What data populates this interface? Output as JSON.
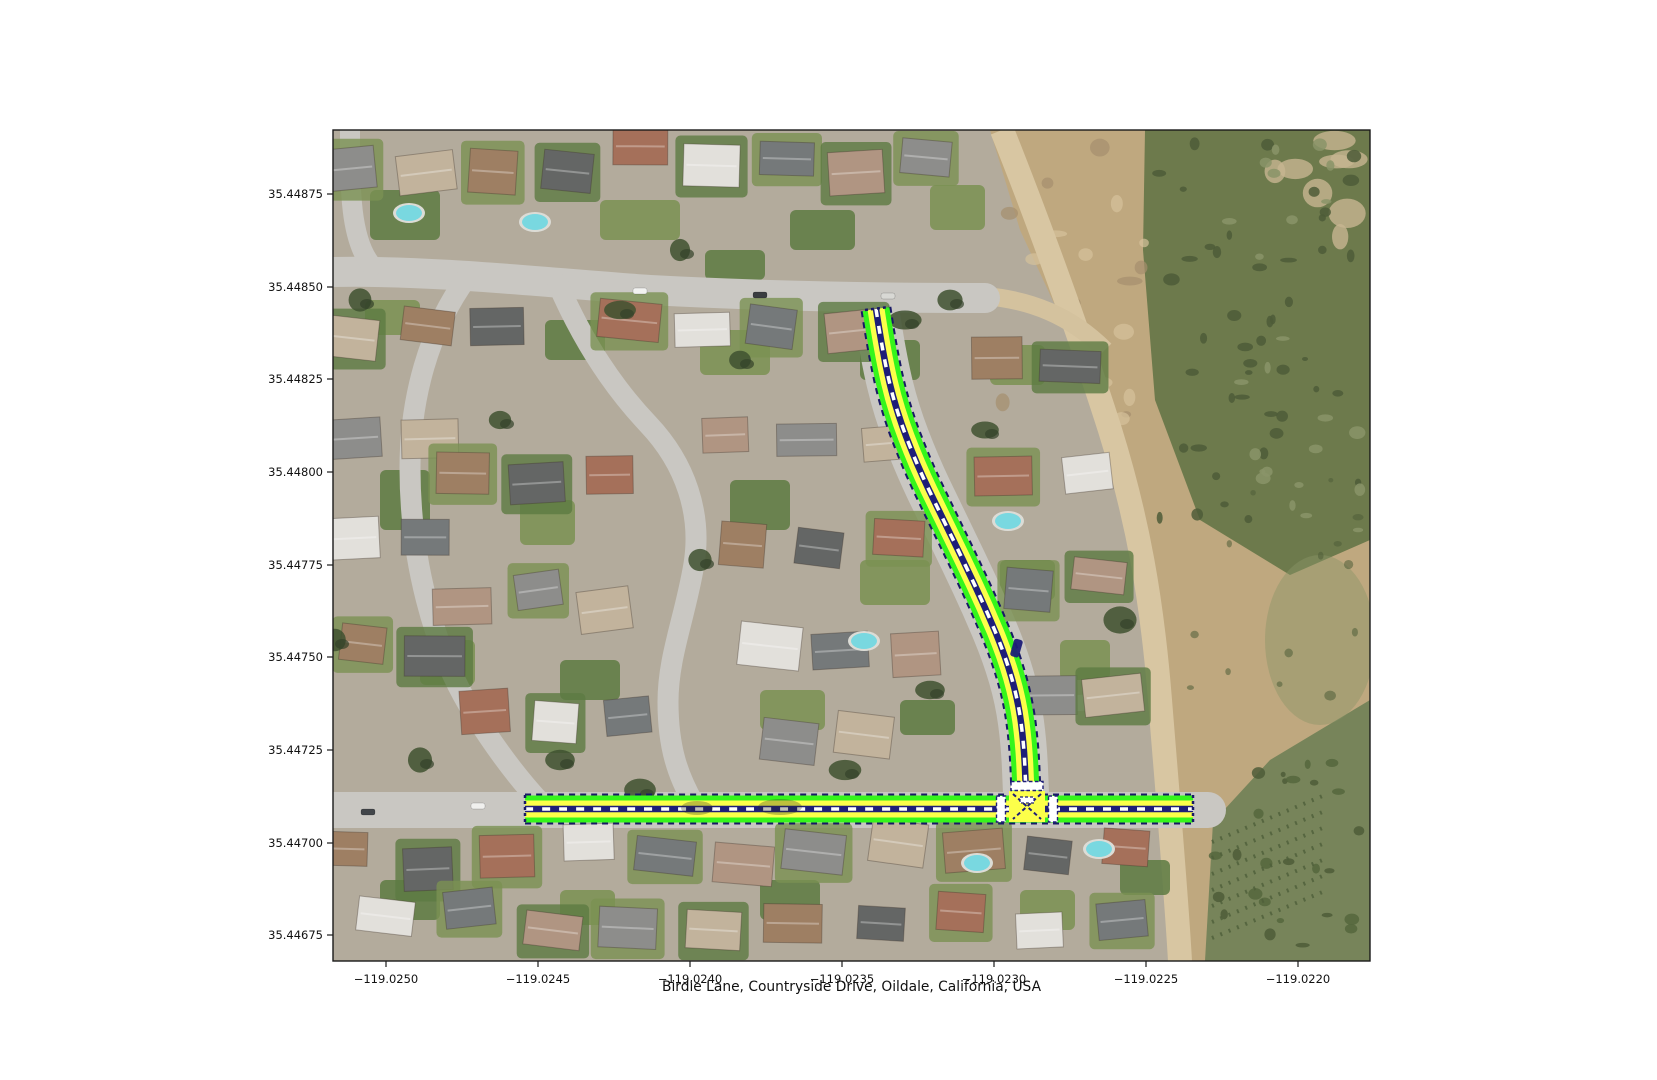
{
  "figure": {
    "title": "Birdie Lane, Countryside Drive, Oildale, California, USA",
    "x_axis": {
      "ticks": [
        "−119.0250",
        "−119.0245",
        "−119.0240",
        "−119.0235",
        "−119.0230",
        "−119.0225",
        "−119.0220"
      ]
    },
    "y_axis": {
      "ticks": [
        "35.44875",
        "35.44850",
        "35.44825",
        "35.44800",
        "35.44775",
        "35.44750",
        "35.44725",
        "35.44700",
        "35.44675"
      ]
    }
  },
  "map": {
    "route_overlay": {
      "colors": {
        "edge_green": "#35f51c",
        "lane_yellow": "#fcff4a",
        "center_navy": "#1e1e78",
        "border_navy": "#191966",
        "marking_white": "#ffffff"
      },
      "roads": [
        {
          "name": "Countryside Drive",
          "points": [
            [
              876,
              309
            ],
            [
              883,
              355
            ],
            [
              896,
              410
            ],
            [
              917,
              465
            ],
            [
              941,
              515
            ],
            [
              963,
              560
            ],
            [
              985,
              607
            ],
            [
              1005,
              655
            ],
            [
              1018,
              700
            ],
            [
              1024,
              745
            ],
            [
              1026,
              793
            ]
          ]
        },
        {
          "name": "Birdie Lane",
          "points": [
            [
              525,
              809
            ],
            [
              860,
              809
            ],
            [
              1193,
              809
            ]
          ]
        }
      ],
      "stop_bars": [
        {
          "cx": 1027,
          "cy": 786,
          "w": 32,
          "h": 9
        },
        {
          "cx": 1001,
          "cy": 809,
          "w": 9,
          "h": 26
        },
        {
          "cx": 1053,
          "cy": 809,
          "w": 9,
          "h": 26
        }
      ],
      "intersection": {
        "cx": 1027,
        "cy": 806
      }
    },
    "palette": {
      "street": "#c9c7c2",
      "street_light": "#d3d1cc",
      "lot_base": "#b3ab9c",
      "sand": "#bfa87f",
      "dirt_road": "#d8c6a2",
      "scrub": "#6d7a4c",
      "scrub_dark": "#4e5c38",
      "lawn": "#7a9152",
      "lawn_dark": "#5d7a42",
      "pool": "#79d8e0",
      "tree": "#3f5130",
      "roofs": [
        "#8d8d8b",
        "#c2b39c",
        "#9e7f63",
        "#646665",
        "#a5705a",
        "#e2e0db",
        "#75797a",
        "#b09582"
      ]
    }
  }
}
